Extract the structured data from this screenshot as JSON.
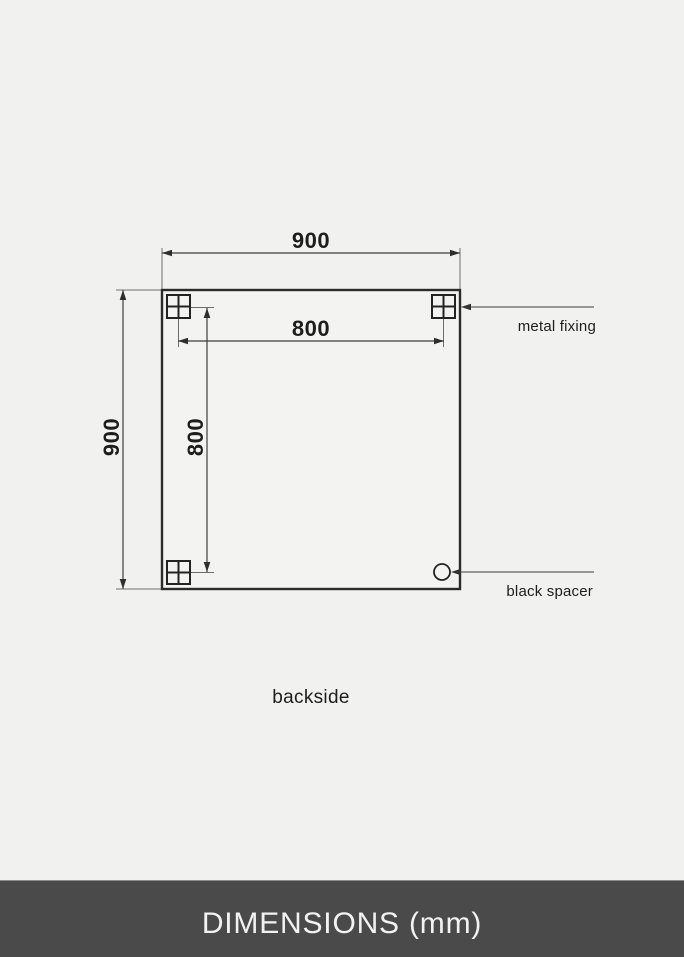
{
  "diagram": {
    "view_label": "backside",
    "dimensions": {
      "overall_width_mm": "900",
      "overall_height_mm": "900",
      "fixing_spacing_horizontal_mm": "800",
      "fixing_spacing_vertical_mm": "800"
    },
    "callouts": {
      "metal_fixing": "metal fixing",
      "black_spacer": "black spacer"
    }
  },
  "footer": {
    "title": "DIMENSIONS (mm)"
  },
  "colors": {
    "background": "#f1f1f0",
    "outline": "#2b2b2b",
    "dimension_line": "#3d3d3d",
    "extension_line": "#6e6e6e",
    "text": "#1d1d1d",
    "footer_background": "#4a4a4a",
    "footer_text": "#f2f2f2"
  }
}
